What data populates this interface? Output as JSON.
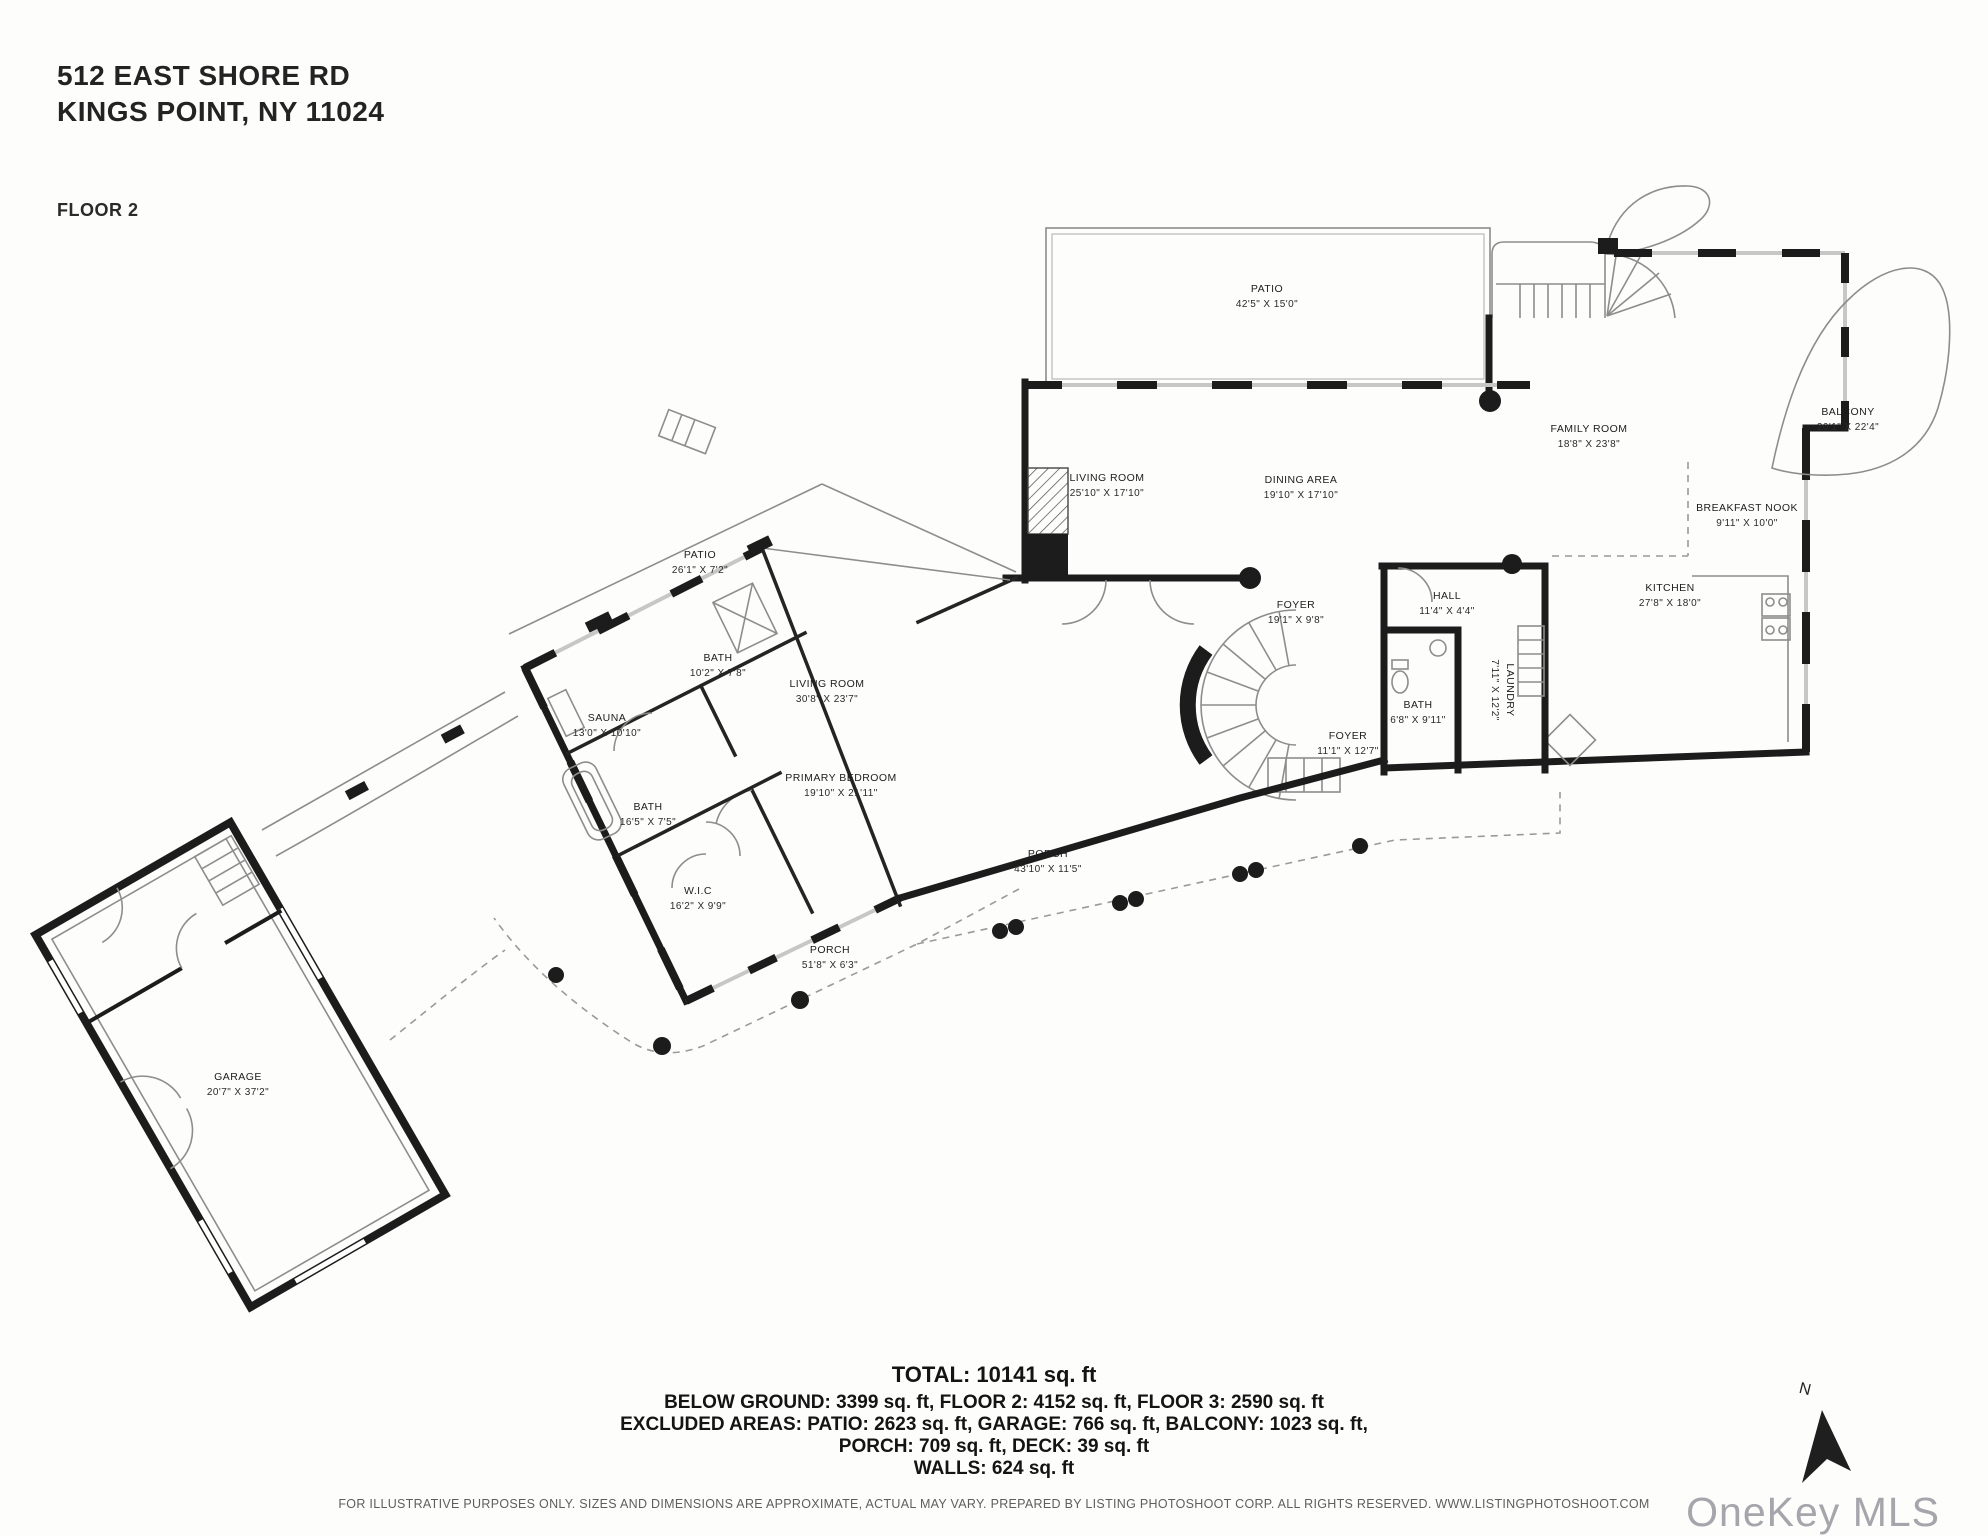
{
  "header": {
    "address_line1": "512 EAST SHORE RD",
    "address_line2": "KINGS POINT, NY 11024",
    "floor_label": "FLOOR 2"
  },
  "plan": {
    "compass_label": "N",
    "rooms": [
      {
        "name": "PATIO",
        "dims": "42'5\" X 15'0\"",
        "x": 1267,
        "y": 297
      },
      {
        "name": "LIVING ROOM",
        "dims": "25'10\" X 17'10\"",
        "x": 1107,
        "y": 486
      },
      {
        "name": "DINING AREA",
        "dims": "19'10\" X 17'10\"",
        "x": 1301,
        "y": 488
      },
      {
        "name": "FAMILY ROOM",
        "dims": "18'8\" X 23'8\"",
        "x": 1589,
        "y": 437
      },
      {
        "name": "BALCONY",
        "dims": "20'1\" X 22'4\"",
        "x": 1848,
        "y": 420
      },
      {
        "name": "BREAKFAST NOOK",
        "dims": "9'11\" X 10'0\"",
        "x": 1747,
        "y": 516
      },
      {
        "name": "KITCHEN",
        "dims": "27'8\" X 18'0\"",
        "x": 1670,
        "y": 596
      },
      {
        "name": "FOYER",
        "dims": "19'1\" X 9'8\"",
        "x": 1296,
        "y": 613
      },
      {
        "name": "HALL",
        "dims": "11'4\" X 4'4\"",
        "x": 1447,
        "y": 604
      },
      {
        "name": "BATH",
        "dims": "6'8\" X 9'11\"",
        "x": 1418,
        "y": 713
      },
      {
        "name": "LAUNDRY",
        "dims": "7'11\" X 12'2\"",
        "x": 1502,
        "y": 690,
        "rotate": 90
      },
      {
        "name": "FOYER",
        "dims": "11'1\" X 12'7\"",
        "x": 1348,
        "y": 744
      },
      {
        "name": "LIVING ROOM",
        "dims": "30'8\" X 23'7\"",
        "x": 827,
        "y": 692
      },
      {
        "name": "PRIMARY BEDROOM",
        "dims": "19'10\" X 21'11\"",
        "x": 841,
        "y": 786
      },
      {
        "name": "PATIO",
        "dims": "26'1\" X 7'2\"",
        "x": 700,
        "y": 563
      },
      {
        "name": "BATH",
        "dims": "10'2\" X 7'8\"",
        "x": 718,
        "y": 666
      },
      {
        "name": "SAUNA",
        "dims": "13'0\" X 10'10\"",
        "x": 607,
        "y": 726
      },
      {
        "name": "BATH",
        "dims": "16'5\" X 7'5\"",
        "x": 648,
        "y": 815
      },
      {
        "name": "W.I.C",
        "dims": "16'2\" X 9'9\"",
        "x": 698,
        "y": 899
      },
      {
        "name": "PORCH",
        "dims": "51'8\" X 6'3\"",
        "x": 830,
        "y": 958
      },
      {
        "name": "PORCH",
        "dims": "43'10\" X 11'5\"",
        "x": 1048,
        "y": 862
      },
      {
        "name": "GARAGE",
        "dims": "20'7\" X 37'2\"",
        "x": 238,
        "y": 1085
      }
    ]
  },
  "summary": {
    "total": "TOTAL: 10141 sq. ft",
    "lines": [
      "BELOW GROUND: 3399 sq. ft, FLOOR 2: 4152 sq. ft, FLOOR 3: 2590 sq. ft",
      "EXCLUDED AREAS: PATIO: 2623 sq. ft, GARAGE: 766 sq. ft, BALCONY: 1023 sq. ft,",
      "PORCH: 709 sq. ft, DECK: 39 sq. ft",
      "WALLS: 624 sq. ft"
    ]
  },
  "disclaimer": "FOR ILLUSTRATIVE PURPOSES ONLY. SIZES AND DIMENSIONS ARE APPROXIMATE, ACTUAL MAY VARY. PREPARED BY LISTING PHOTOSHOOT CORP. ALL RIGHTS RESERVED. WWW.LISTINGPHOTOSHOOT.COM",
  "watermark": "OneKey MLS",
  "colors": {
    "wall": "#1c1c1c",
    "thin_line": "#8d8d8d",
    "text": "#1d1d1d",
    "muted_text": "#5e5e5e",
    "watermark": "#a5a5ab"
  }
}
